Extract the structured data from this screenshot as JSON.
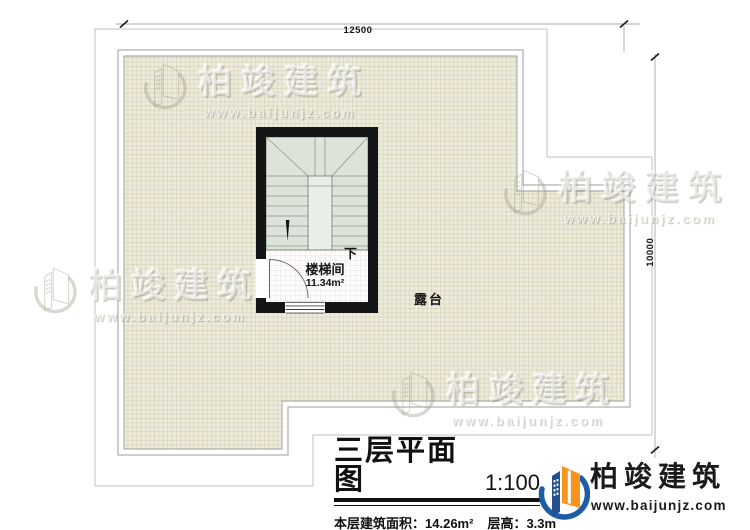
{
  "plan": {
    "dimension_top": "12500",
    "dimension_right": "10000",
    "stairwell_name": "楼梯间",
    "stairwell_area": "11.34m²",
    "stair_direction": "下",
    "terrace_name": "露台"
  },
  "title_block": {
    "title": "三层平面图",
    "scale": "1:100",
    "area_label": "本层建筑面积：",
    "area_value": "14.26m²",
    "height_label": "层高：",
    "height_value": "3.3m"
  },
  "brand": {
    "name": "柏竣建筑",
    "website": "www.baijunjz.com"
  },
  "watermark": {
    "name": "柏竣建筑",
    "website": "www.baijunjz.com"
  },
  "colors": {
    "wall": "#151515",
    "terrace_fill": "#edebdc",
    "terrace_grid": "#d9d4bb",
    "stair_fill": "#dee3da",
    "stair_well_fill": "#eaeee8",
    "brand_orange": "#f7941e",
    "brand_blue": "#1d5ca8",
    "dimension_line": "#a8a8a8"
  }
}
